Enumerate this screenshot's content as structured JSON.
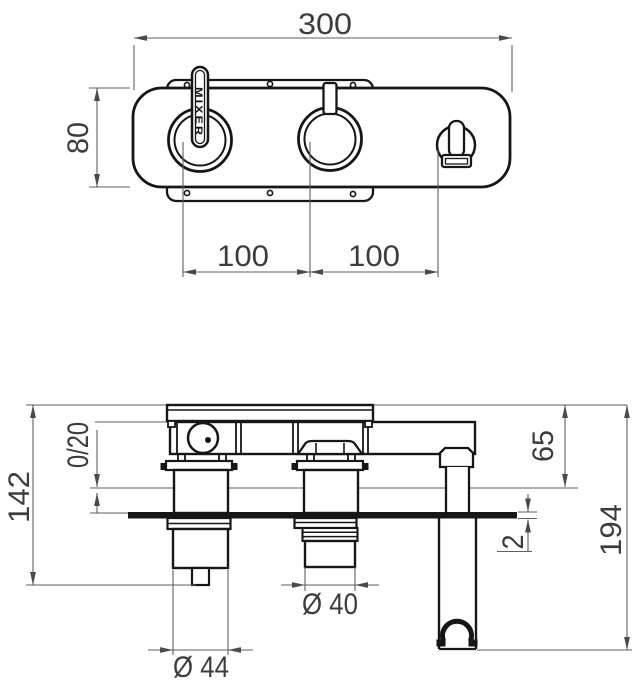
{
  "drawing": {
    "type": "technical-dimension-drawing",
    "subject": "concealed shower mixer valve, front view and section view",
    "line_color": "#161616",
    "dimension_color": "#5f5f5f"
  },
  "dimensions": {
    "top_view": {
      "overall_width": "300",
      "overall_height": "80",
      "left_handle_spacing": "100",
      "right_handle_spacing": "100",
      "handle_label": "MIXER"
    },
    "section_view": {
      "total_depth": "142",
      "adjustment_range": "0/20",
      "outlet_offset": "65",
      "plate_thickness": "2",
      "holder_length": "194",
      "middle_cartridge_diameter": "Ø 40",
      "left_cartridge_diameter": "Ø 44"
    }
  }
}
